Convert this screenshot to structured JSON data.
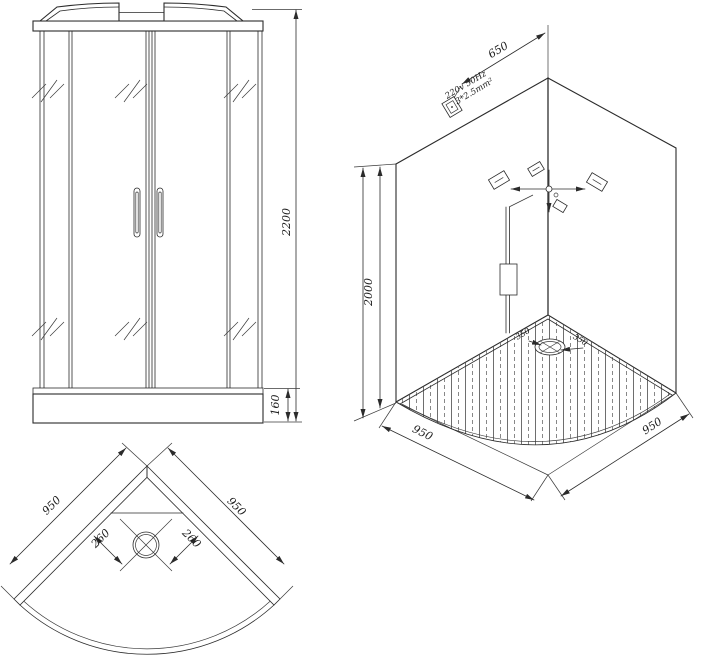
{
  "views": {
    "front": {
      "overall_height": "2200",
      "tray_height": "160"
    },
    "iso": {
      "socket_distance": "650",
      "power_spec_line1": "220v 50Hz",
      "power_spec_line2": "3*2.5mm²",
      "wall_height": "2000",
      "base_side_left": "950",
      "base_side_right": "950",
      "drain_offset_left": "350",
      "drain_offset_right": "350"
    },
    "plan": {
      "side_left": "950",
      "side_right": "950",
      "drain_offset_left": "260",
      "drain_offset_right": "260"
    }
  },
  "colors": {
    "line": "#2b2b2b",
    "background": "#ffffff"
  }
}
